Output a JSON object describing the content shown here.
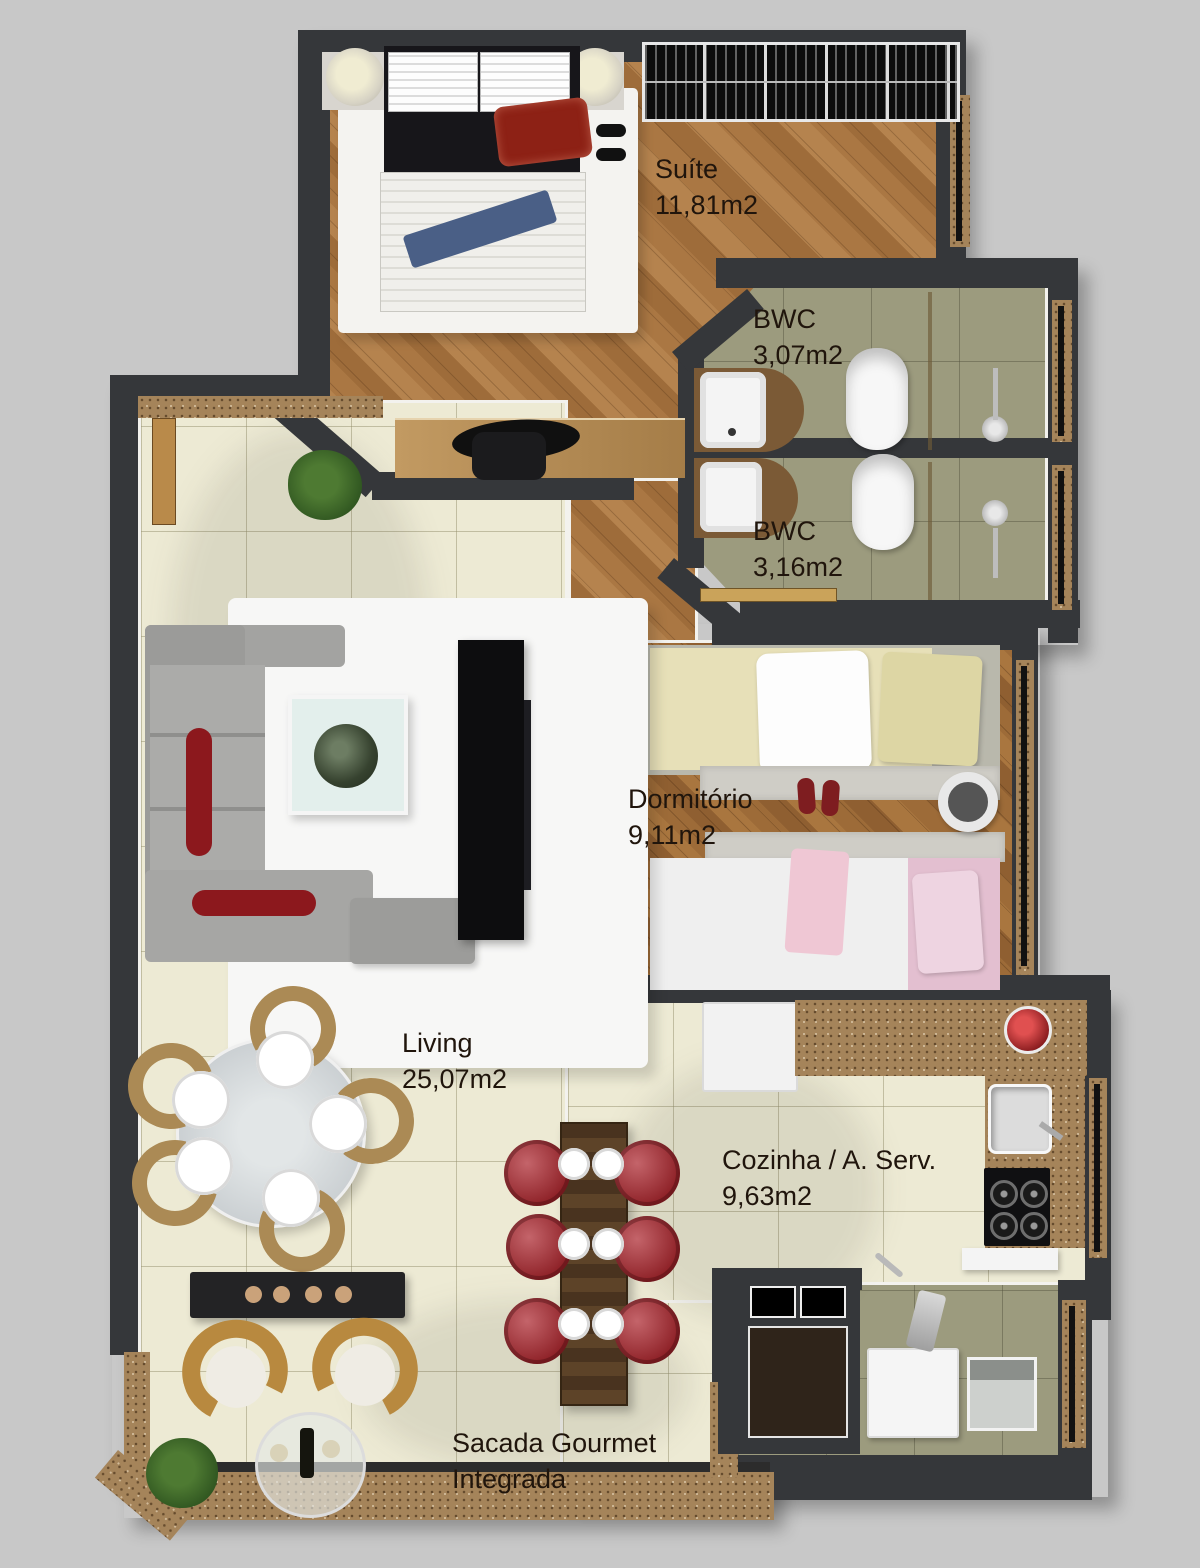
{
  "rooms": {
    "suite": {
      "name": "Suíte",
      "area": "11,81m2"
    },
    "bwc1": {
      "name": "BWC",
      "area": "3,07m2"
    },
    "bwc2": {
      "name": "BWC",
      "area": "3,16m2"
    },
    "dormitorio": {
      "name": "Dormitório",
      "area": "9,11m2"
    },
    "living": {
      "name": "Living",
      "area": "25,07m2"
    },
    "cozinha": {
      "name": "Cozinha / A. Serv.",
      "area": "9,63m2"
    },
    "sacada": {
      "name": "Sacada Gourmet",
      "name2": "Integrada"
    }
  },
  "colors": {
    "background": "#c8c8c8",
    "wall": "#35373a",
    "wood_floor": "#aa7743",
    "cream_tile": "#edead4",
    "bath_tile": "#9c9b7e",
    "granite": "#a5845a",
    "accent_red": "#8e2127",
    "label_text": "#20150c"
  }
}
